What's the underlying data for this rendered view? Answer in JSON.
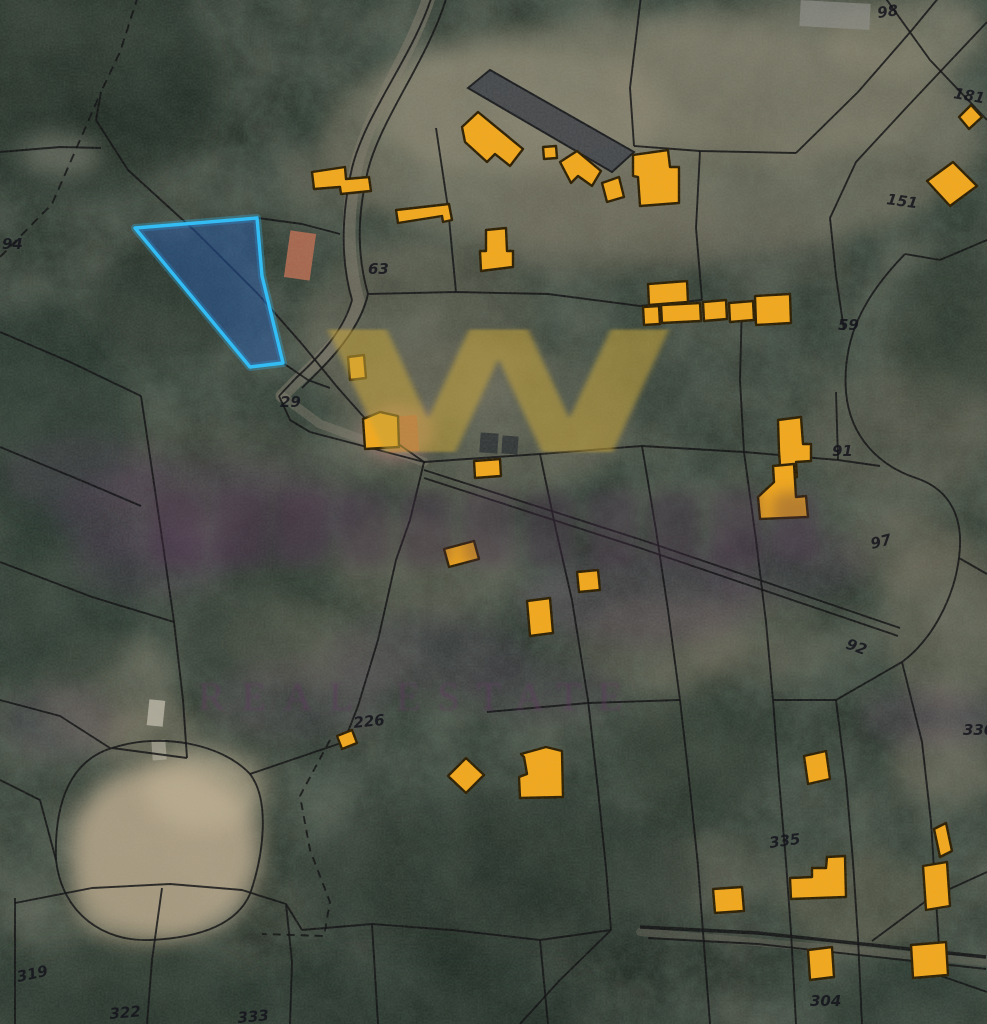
{
  "map": {
    "kind": "cadastral-parcel-satellite-view",
    "style": {
      "boundary_color": "#0f0f12",
      "building_fill": "#f2a71b",
      "building_stroke": "#2b1d00",
      "parcel_highlight_stroke": "#33bdf4",
      "parcel_highlight_fill": "rgba(38,98,190,0.42)",
      "label_color": "#14141c",
      "watermark_gold": "rgba(197,164,60,0.55)",
      "watermark_purple": "#5a3a5f"
    },
    "highlighted_parcel": {
      "points": "135,228 257,218 262,276 283,363 250,367"
    },
    "parcel_labels": [
      {
        "t": "94",
        "x": 2,
        "y": 249,
        "r": 0
      },
      {
        "t": "98",
        "x": 878,
        "y": 18,
        "r": -8
      },
      {
        "t": "181",
        "x": 953,
        "y": 98,
        "r": 10
      },
      {
        "t": "151",
        "x": 886,
        "y": 204,
        "r": 8
      },
      {
        "t": "59",
        "x": 838,
        "y": 330,
        "r": 0
      },
      {
        "t": "63",
        "x": 368,
        "y": 274,
        "r": 0
      },
      {
        "t": "29",
        "x": 280,
        "y": 407,
        "r": 0
      },
      {
        "t": "91",
        "x": 832,
        "y": 456,
        "r": 0
      },
      {
        "t": "97",
        "x": 872,
        "y": 549,
        "r": -14
      },
      {
        "t": "92",
        "x": 845,
        "y": 648,
        "r": 20
      },
      {
        "t": "330",
        "x": 963,
        "y": 735,
        "r": 0
      },
      {
        "t": "226",
        "x": 354,
        "y": 728,
        "r": -6
      },
      {
        "t": "335",
        "x": 770,
        "y": 848,
        "r": -8
      },
      {
        "t": "304",
        "x": 810,
        "y": 1006,
        "r": 0
      },
      {
        "t": "319",
        "x": 18,
        "y": 982,
        "r": -12
      },
      {
        "t": "322",
        "x": 110,
        "y": 1019,
        "r": -5
      },
      {
        "t": "333",
        "x": 238,
        "y": 1023,
        "r": -5
      }
    ],
    "buildings": [
      "312,172 345,167 346,179 369,177 371,191 341,194 340,187 314,189",
      "396,210 449,204 452,220 443,222 442,216 398,223",
      "462,127 478,112 523,149 510,166 495,154 487,162 465,142",
      "543,147 556,146 557,158 544,159",
      "560,162 577,151 601,171 592,186 578,176 571,183",
      "602,183 619,177 624,197 607,202",
      "633,155 668,150 670,167 679,167 679,203 640,206 638,177 633,176",
      "486,230 506,228 507,251 513,251 513,267 481,271 480,251 486,251",
      "648,284 687,281 688,302 649,305",
      "643,307 659,306 660,324 644,325",
      "661,305 700,303 701,321 662,323",
      "703,302 726,300 727,319 704,321",
      "729,303 753,301 754,320 730,322",
      "755,296 790,294 791,323 756,325",
      "959,117 971,105 982,117 969,129",
      "927,181 953,162 977,186 950,206",
      "778,420 801,417 803,444 811,444 811,461 796,462 797,477 781,478 779,452",
      "758,497 774,482 773,466 794,464 796,497 806,496 808,517 760,519",
      "348,357 364,355 366,378 350,380",
      "363,419 380,412 398,416 399,447 365,449",
      "444,549 474,541 479,559 449,567",
      "474,461 500,459 501,476 475,478",
      "527,601 550,598 553,633 530,636",
      "577,572 598,570 600,590 579,592",
      "466,758 484,775 466,793 448,776",
      "521,754 546,747 562,751 563,797 520,798 519,777 527,774 524,757",
      "337,736 352,730 357,743 342,749",
      "713,889 742,887 744,911 715,913",
      "827,857 845,856 846,897 791,899 790,878 812,877 812,868 826,868",
      "804,756 826,751 830,779 808,784",
      "934,829 946,823 952,851 940,857",
      "923,866 947,862 950,906 926,910",
      "911,945 946,942 948,975 913,978",
      "808,950 832,947 834,977 810,980"
    ],
    "boundaries": [
      {
        "d": "M138,-4 L120,52 L101,92",
        "dash": "9 6"
      },
      {
        "d": "M0,257 L52,204 L101,92",
        "dash": "9 6"
      },
      {
        "d": "M0,152 L60,147 L101,148"
      },
      {
        "d": "M101,92 L96,120 L128,170 L196,232 L258,294 L302,344 L338,388 L370,424 L424,462"
      },
      {
        "d": "M432,-4 C412,58 366,112 352,168 C342,212 340,258 352,300"
      },
      {
        "d": "M447,-4 C428,60 382,116 368,170 C358,212 356,252 368,294"
      },
      {
        "d": "M352,300 C344,330 320,356 296,378 L279,396"
      },
      {
        "d": "M368,294 C362,322 340,350 318,372 L302,388"
      },
      {
        "d": "M279,396 L290,420 L310,432 L424,462"
      },
      {
        "d": "M641,-4 L630,88 L634,146"
      },
      {
        "d": "M634,146 L700,151 L796,153"
      },
      {
        "d": "M436,128 L448,208 L456,292"
      },
      {
        "d": "M700,151 L696,228 L702,300"
      },
      {
        "d": "M368,294 L456,292 L548,294 L640,306 L702,300"
      },
      {
        "d": "M796,153 L858,92 L912,30 L940,-4"
      },
      {
        "d": "M987,22 L906,108 L856,162 L830,218 L836,276 L844,330"
      },
      {
        "d": "M987,120 L930,60 L884,-4"
      },
      {
        "d": "M905,254 C864,296 842,338 846,392 C850,438 880,466 916,478 C952,490 964,520 959,558 C954,598 932,640 902,662"
      },
      {
        "d": "M987,240 L940,260 L905,254"
      },
      {
        "d": "M424,462 L540,454 L642,446 L744,452 L838,460 L880,466"
      },
      {
        "d": "M744,452 L740,380 L742,302"
      },
      {
        "d": "M838,460 L836,392"
      },
      {
        "d": "M424,462 L410,520 L396,560 L378,640 L358,706 L344,742"
      },
      {
        "d": "M540,454 L556,530 L572,600 L588,700 L598,790 L606,868 L611,930"
      },
      {
        "d": "M642,446 L656,530 L668,610 L680,700 L690,788 L698,866 L703,932"
      },
      {
        "d": "M744,452 L756,540 L766,622 L773,700"
      },
      {
        "d": "M773,700 L836,700 L902,662"
      },
      {
        "d": "M773,700 L779,780 L786,862 L791,932"
      },
      {
        "d": "M487,712 L588,703 L680,700"
      },
      {
        "d": "M836,700 L846,780 L853,862 L858,938"
      },
      {
        "d": "M902,662 L922,742 L931,822 L936,900 L941,976"
      },
      {
        "d": "M959,558 L987,574"
      },
      {
        "d": "M941,976 L987,992"
      },
      {
        "d": "M640,927 L758,933 L986,957",
        "w": 3.4
      },
      {
        "d": "M648,938 L758,944 L986,969"
      },
      {
        "d": "M872,941 L930,898 L987,872"
      },
      {
        "d": "M611,930 L560,980 L520,1024"
      },
      {
        "d": "M703,932 L710,1024"
      },
      {
        "d": "M791,932 L796,1024"
      },
      {
        "d": "M858,938 L862,1024"
      },
      {
        "d": "M56,860 C54,800 72,760 112,748 C162,732 222,744 250,774 C270,800 264,854 250,894 C236,926 196,938 150,940 C104,942 62,914 56,860 Z"
      },
      {
        "d": "M330,740 L300,796 L310,850 L330,902 L324,936 L262,934",
        "dash": "8 6"
      },
      {
        "d": "M344,742 L250,774"
      },
      {
        "d": "M0,332 L70,362 L141,396"
      },
      {
        "d": "M141,396 L152,470 L163,545 L174,622 L183,700 L187,758"
      },
      {
        "d": "M0,447 L80,480 L141,506"
      },
      {
        "d": "M0,562 L92,597 L174,622"
      },
      {
        "d": "M187,758 L112,748"
      },
      {
        "d": "M15,898 L15,1024"
      },
      {
        "d": "M15,903 L92,888 L170,884 L242,890 L286,904 L302,930"
      },
      {
        "d": "M162,888 L152,960 L147,1024"
      },
      {
        "d": "M286,904 L292,962 L290,1024"
      },
      {
        "d": "M302,930 L372,924 L452,930 L540,940 L611,930"
      },
      {
        "d": "M372,924 L378,1024"
      },
      {
        "d": "M540,940 L548,1024"
      },
      {
        "d": "M258,218 L302,224 L340,234"
      },
      {
        "d": "M283,363 L308,380 L330,388"
      },
      {
        "d": "M424,470 L642,540 L900,628"
      },
      {
        "d": "M424,478 L640,548 L898,636"
      },
      {
        "d": "M0,700 L60,716 L110,748"
      },
      {
        "d": "M0,780 L40,800 L56,860"
      }
    ],
    "roads": [
      {
        "d": "M430,-6 C410,58 368,112 356,168 C347,212 346,258 358,300 C350,332 322,358 298,380 L282,396",
        "w": 13,
        "c": "#7e7869",
        "o": 0.55
      },
      {
        "d": "M282,396 L320,424 L424,462",
        "w": 9,
        "c": "#8a8374",
        "o": 0.4
      },
      {
        "d": "M640,932 L986,962",
        "w": 8,
        "c": "#6e685c",
        "o": 0.4
      }
    ],
    "terrain_patches": [
      [
        650,
        140,
        330,
        120,
        "#8f8873",
        0.45
      ],
      [
        520,
        110,
        150,
        65,
        "#9d947e",
        0.4
      ],
      [
        780,
        80,
        170,
        80,
        "#8a8370",
        0.4
      ],
      [
        905,
        35,
        80,
        40,
        "#9a927c",
        0.45
      ],
      [
        420,
        330,
        120,
        90,
        "#78715f",
        0.35
      ],
      [
        480,
        420,
        150,
        80,
        "#857d6b",
        0.3
      ],
      [
        165,
        852,
        95,
        88,
        "#b1a287",
        0.9
      ],
      [
        205,
        790,
        60,
        40,
        "#bfb093",
        0.65
      ],
      [
        135,
        902,
        60,
        45,
        "#a4987e",
        0.7
      ],
      [
        60,
        155,
        42,
        22,
        "#cac4b2",
        0.7
      ],
      [
        898,
        432,
        95,
        65,
        "#6e695a",
        0.35
      ],
      [
        948,
        622,
        68,
        88,
        "#857d6b",
        0.38
      ],
      [
        905,
        545,
        60,
        45,
        "#77705f",
        0.3
      ],
      [
        420,
        568,
        95,
        52,
        "#847c6a",
        0.28
      ],
      [
        660,
        645,
        85,
        50,
        "#7b7260",
        0.3
      ],
      [
        760,
        635,
        70,
        45,
        "#6e6757",
        0.28
      ],
      [
        300,
        642,
        75,
        42,
        "#67604f",
        0.22
      ],
      [
        945,
        762,
        55,
        38,
        "#8d8471",
        0.35
      ],
      [
        862,
        902,
        78,
        48,
        "#7f775f",
        0.3
      ],
      [
        712,
        872,
        60,
        40,
        "#6a6352",
        0.25
      ],
      [
        230,
        480,
        120,
        60,
        "#56534a",
        0.25
      ],
      [
        110,
        690,
        70,
        60,
        "#8d8471",
        0.3
      ],
      [
        150,
        735,
        50,
        35,
        "#9a9078",
        0.35
      ],
      [
        340,
        180,
        60,
        35,
        "#756e5d",
        0.3
      ],
      [
        600,
        220,
        120,
        60,
        "#6f695a",
        0.3
      ],
      [
        760,
        250,
        90,
        40,
        "#5d5a50",
        0.25
      ],
      [
        80,
        80,
        140,
        120,
        "#222d26",
        0.55
      ],
      [
        40,
        420,
        90,
        120,
        "#243029",
        0.5
      ],
      [
        60,
        600,
        80,
        90,
        "#243029",
        0.45
      ],
      [
        500,
        880,
        200,
        90,
        "#263129",
        0.5
      ],
      [
        120,
        1000,
        150,
        60,
        "#1f2922",
        0.5
      ],
      [
        420,
        1000,
        180,
        50,
        "#243029",
        0.45
      ],
      [
        900,
        1000,
        90,
        40,
        "#243029",
        0.4
      ],
      [
        690,
        760,
        80,
        60,
        "#2a352c",
        0.45
      ],
      [
        950,
        330,
        60,
        80,
        "#2a352c",
        0.4
      ],
      [
        280,
        560,
        60,
        50,
        "#2a352c",
        0.4
      ],
      [
        640,
        390,
        80,
        40,
        "#4a5146",
        0.35
      ],
      [
        170,
        300,
        80,
        60,
        "#28332b",
        0.5
      ],
      [
        230,
        640,
        60,
        40,
        "#303b31",
        0.4
      ]
    ],
    "photo_features": [
      {
        "type": "rect",
        "x": 287,
        "y": 232,
        "w": 26,
        "h": 47,
        "r": 8,
        "fill": "#b26a50",
        "o": 0.9
      },
      {
        "type": "ellipse",
        "cx": 398,
        "cy": 432,
        "rx": 36,
        "ry": 28,
        "fill": "#cf8a84",
        "o": 0.5
      },
      {
        "type": "rect",
        "x": 388,
        "y": 416,
        "w": 30,
        "h": 36,
        "r": -4,
        "fill": "#b85948",
        "o": 0.85
      },
      {
        "type": "rect",
        "x": 800,
        "y": 2,
        "w": 70,
        "h": 26,
        "r": 3,
        "fill": "#8b8b86",
        "o": 0.7
      },
      {
        "type": "rect",
        "x": 148,
        "y": 700,
        "w": 16,
        "h": 26,
        "r": 6,
        "fill": "#c9c3b4",
        "o": 0.7
      },
      {
        "type": "rect",
        "x": 152,
        "y": 740,
        "w": 14,
        "h": 20,
        "r": -4,
        "fill": "#b8b2a2",
        "o": 0.6
      },
      {
        "type": "poly",
        "points": "468,88 490,70 634,152 612,172",
        "fill": "#43464a",
        "stroke": "#15161a",
        "o": 0.95
      },
      {
        "type": "rect",
        "x": 480,
        "y": 433,
        "w": 18,
        "h": 20,
        "r": 4,
        "fill": "#2c3033",
        "o": 0.85
      },
      {
        "type": "rect",
        "x": 502,
        "y": 436,
        "w": 16,
        "h": 18,
        "r": 4,
        "fill": "#2c3033",
        "o": 0.85
      }
    ]
  },
  "watermark": {
    "monogram": "W",
    "subtitle": "REAL ESTATE",
    "haze": [
      [
        205,
        515,
        150,
        55,
        0.26
      ],
      [
        85,
        475,
        85,
        40,
        0.2
      ],
      [
        640,
        600,
        120,
        45,
        0.24
      ],
      [
        430,
        655,
        100,
        40,
        0.18
      ],
      [
        930,
        718,
        70,
        28,
        0.24
      ],
      [
        60,
        722,
        60,
        35,
        0.18
      ],
      [
        782,
        562,
        85,
        38,
        0.2
      ],
      [
        300,
        700,
        90,
        40,
        0.16
      ],
      [
        150,
        560,
        80,
        40,
        0.2
      ],
      [
        540,
        690,
        80,
        30,
        0.16
      ]
    ],
    "brand_word_blobs": [
      [
        152,
        492,
        52,
        74
      ],
      [
        214,
        490,
        52,
        76
      ],
      [
        276,
        492,
        52,
        74
      ],
      [
        338,
        490,
        52,
        76
      ],
      [
        400,
        492,
        52,
        74
      ],
      [
        462,
        490,
        52,
        76
      ],
      [
        524,
        492,
        52,
        74
      ],
      [
        586,
        490,
        52,
        76
      ],
      [
        648,
        492,
        52,
        74
      ],
      [
        710,
        490,
        52,
        76
      ],
      [
        772,
        492,
        46,
        70
      ]
    ]
  }
}
